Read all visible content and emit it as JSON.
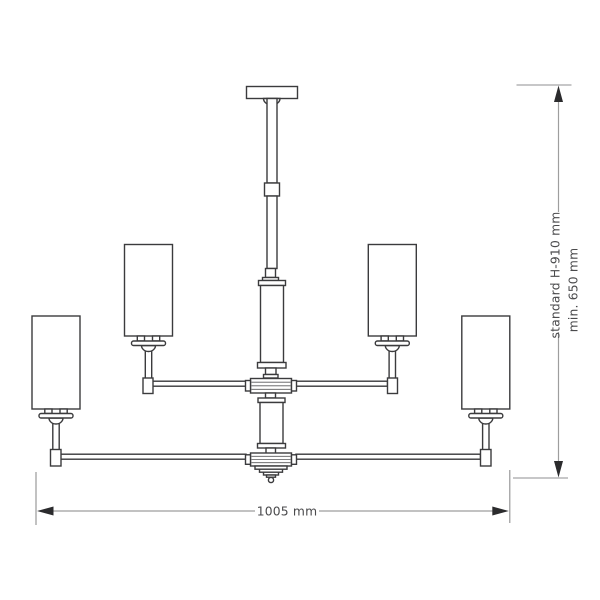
{
  "dimensions": {
    "height": {
      "standard_label": "standard H-910 mm",
      "min_label": "min. 650 mm"
    },
    "width": {
      "label": "1005 mm"
    }
  },
  "colors": {
    "line": "#3b3b3d",
    "dimension_line": "#9e9e9e",
    "arrow": "#2b2b2d",
    "label_text": "#4a4a4c",
    "background": "#ffffff"
  }
}
